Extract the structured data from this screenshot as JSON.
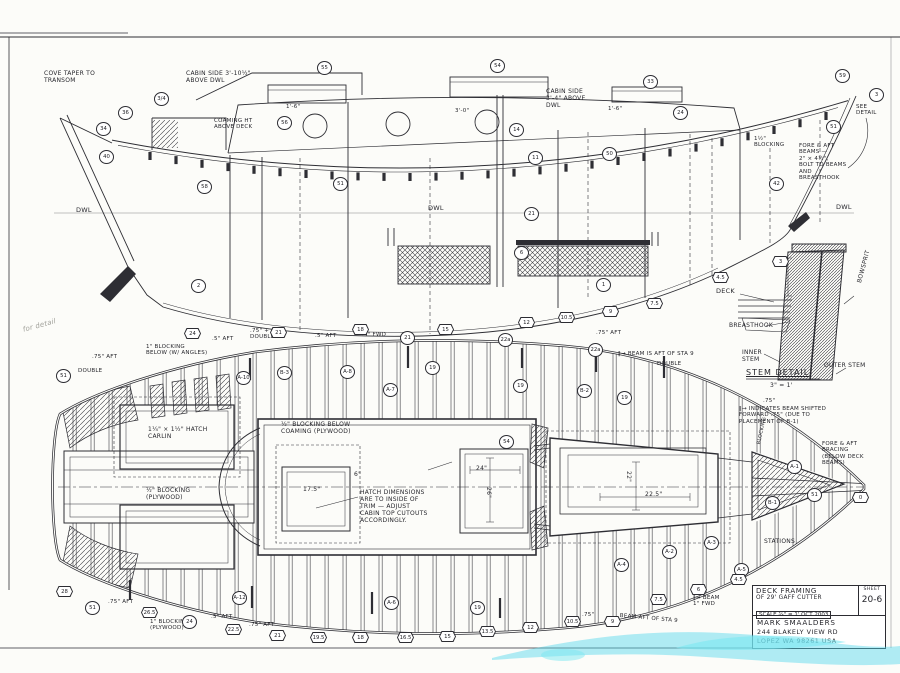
{
  "sheet": {
    "background": "#fcfcf9",
    "ink": "#2e2e34",
    "watermark_color": "#52d8ea"
  },
  "title_block": {
    "title": "DECK FRAMING",
    "subtitle": "OF 29' GAFF CUTTER",
    "scale_line": "SCALE ¾\" = 1'   OCT 2003",
    "designer": "MARK SMAALDERS",
    "address_line1": "244 BLAKELY VIEW RD",
    "address_line2": "LOPEZ WA 98261 USA",
    "sheet_label": "SHEET",
    "sheet_number": "20-6"
  },
  "stem_detail": {
    "title": "STEM DETAIL",
    "scale": "3\" = 1'",
    "labels": [
      {
        "t": "DECK",
        "x": 716,
        "y": 288,
        "s": 6.5
      },
      {
        "t": "BREASTHOOK",
        "x": 729,
        "y": 322,
        "s": 6
      },
      {
        "t": "INNER\nSTEM",
        "x": 742,
        "y": 349,
        "s": 6
      },
      {
        "t": "OUTER STEM",
        "x": 824,
        "y": 362,
        "s": 6
      },
      {
        "t": "BOWSPRIT",
        "x": 856,
        "y": 282,
        "r": -75,
        "s": 6
      }
    ]
  },
  "profile_view": {
    "annotations": [
      {
        "t": "COVE TAPER TO\nTRANSOM",
        "x": 44,
        "y": 70,
        "s": 6
      },
      {
        "t": "CABIN SIDE 3'-10½\"\nABOVE DWL",
        "x": 186,
        "y": 70,
        "s": 6
      },
      {
        "t": "COAMING HT\nABOVE DECK",
        "x": 214,
        "y": 118,
        "s": 5.5
      },
      {
        "t": "1'-6\"",
        "x": 286,
        "y": 104,
        "s": 5.5
      },
      {
        "t": "3'-0\"",
        "x": 455,
        "y": 108,
        "s": 5.5
      },
      {
        "t": "1'-6\"",
        "x": 608,
        "y": 106,
        "s": 5.5
      },
      {
        "t": "CABIN SIDE\n3'-4\" ABOVE\nDWL",
        "x": 546,
        "y": 88,
        "s": 6
      },
      {
        "t": "1½\"\nBLOCKING",
        "x": 754,
        "y": 136,
        "s": 5.5
      },
      {
        "t": "FORE & AFT\nBEAMS —\n2\" × 4½\",\nBOLT TO BEAMS\nAND\nBREASTHOOK",
        "x": 799,
        "y": 143,
        "s": 5.5
      },
      {
        "t": "SEE\nDETAIL",
        "x": 856,
        "y": 104,
        "s": 5.5
      },
      {
        "t": "DWL",
        "x": 76,
        "y": 207,
        "s": 6.5
      },
      {
        "t": "DWL",
        "x": 428,
        "y": 205,
        "s": 6.5
      },
      {
        "t": "DWL",
        "x": 836,
        "y": 204,
        "s": 6.5
      }
    ],
    "markers": [
      {
        "shape": "circle",
        "l": "3/4",
        "x": 154,
        "y": 92
      },
      {
        "shape": "circle",
        "l": "36",
        "x": 118,
        "y": 106
      },
      {
        "shape": "circle",
        "l": "34",
        "x": 96,
        "y": 122
      },
      {
        "shape": "circle",
        "l": "40",
        "x": 99,
        "y": 150
      },
      {
        "shape": "circle",
        "l": "58",
        "x": 197,
        "y": 180
      },
      {
        "shape": "circle",
        "l": "56",
        "x": 277,
        "y": 116
      },
      {
        "shape": "circle",
        "l": "55",
        "x": 317,
        "y": 61
      },
      {
        "shape": "circle",
        "l": "51",
        "x": 333,
        "y": 177
      },
      {
        "shape": "circle",
        "l": "54",
        "x": 490,
        "y": 59
      },
      {
        "shape": "circle",
        "l": "14",
        "x": 509,
        "y": 123
      },
      {
        "shape": "circle",
        "l": "11",
        "x": 528,
        "y": 151
      },
      {
        "shape": "circle",
        "l": "33",
        "x": 643,
        "y": 75
      },
      {
        "shape": "circle",
        "l": "24",
        "x": 673,
        "y": 106
      },
      {
        "shape": "circle",
        "l": "50",
        "x": 602,
        "y": 147
      },
      {
        "shape": "circle",
        "l": "59",
        "x": 835,
        "y": 69
      },
      {
        "shape": "circle",
        "l": "3",
        "x": 869,
        "y": 88
      },
      {
        "shape": "circle",
        "l": "51",
        "x": 826,
        "y": 120
      },
      {
        "shape": "circle",
        "l": "42",
        "x": 769,
        "y": 177
      },
      {
        "shape": "circle",
        "l": "21",
        "x": 524,
        "y": 207
      },
      {
        "shape": "circle",
        "l": "6",
        "x": 514,
        "y": 246
      },
      {
        "shape": "circle",
        "l": "1",
        "x": 596,
        "y": 278
      },
      {
        "shape": "circle",
        "l": "2",
        "x": 191,
        "y": 279
      },
      {
        "shape": "hex",
        "l": "10.5",
        "x": 558,
        "y": 312
      },
      {
        "shape": "hex",
        "l": "9",
        "x": 602,
        "y": 306
      },
      {
        "shape": "hex",
        "l": "7.5",
        "x": 646,
        "y": 298
      },
      {
        "shape": "hex",
        "l": "4.5",
        "x": 712,
        "y": 272
      },
      {
        "shape": "hex",
        "l": "3",
        "x": 772,
        "y": 256
      }
    ]
  },
  "plan_view": {
    "annotations": [
      {
        "t": "for detail",
        "x": 22,
        "y": 326,
        "r": -15,
        "pencil": 1
      },
      {
        "t": ".75\" AFT",
        "x": 92,
        "y": 354,
        "s": 5.5
      },
      {
        "t": "DOUBLE",
        "x": 78,
        "y": 368,
        "s": 5.5
      },
      {
        "t": "1\" BLOCKING\nBELOW (W/ ANGLES)",
        "x": 146,
        "y": 344,
        "s": 5.5
      },
      {
        "t": ".5\" AFT",
        "x": 212,
        "y": 336,
        "s": 5.5
      },
      {
        "t": ".75\" +\nDOUBLE",
        "x": 250,
        "y": 328,
        "s": 5.5
      },
      {
        "t": ".5\" AFT",
        "x": 315,
        "y": 333,
        "s": 5.5
      },
      {
        "t": ".5\" FWD",
        "x": 362,
        "y": 332,
        "s": 5.5
      },
      {
        "t": ".75\" AFT",
        "x": 596,
        "y": 330,
        "s": 5.5
      },
      {
        "t": "‖→ BEAM IS AFT OF STA 9",
        "x": 618,
        "y": 351,
        "s": 5.5
      },
      {
        "t": "DOUBLE",
        "x": 657,
        "y": 361,
        "s": 5.5
      },
      {
        "t": "1¼\" × 1½\" HATCH\nCARLIN",
        "x": 148,
        "y": 426,
        "s": 6
      },
      {
        "t": "½\" BLOCKING\n(PLYWOOD)",
        "x": 146,
        "y": 487,
        "s": 6
      },
      {
        "t": "½\" BLOCKING BELOW\nCOAMING (PLYWOOD)",
        "x": 281,
        "y": 421,
        "s": 6
      },
      {
        "t": "HATCH DIMENSIONS\nARE TO INSIDE OF\nTRIM — ADJUST\nCABIN TOP CUTOUTS\nACCORDINGLY.",
        "x": 360,
        "y": 489,
        "s": 6
      },
      {
        "t": "6\"",
        "x": 354,
        "y": 471,
        "s": 6
      },
      {
        "t": "17.5\"",
        "x": 303,
        "y": 486,
        "s": 6
      },
      {
        "t": "24\"",
        "x": 476,
        "y": 465,
        "s": 6
      },
      {
        "t": "26\"",
        "x": 492,
        "y": 487,
        "s": 6,
        "r": 90
      },
      {
        "t": "22\"",
        "x": 632,
        "y": 471,
        "s": 6,
        "r": 90
      },
      {
        "t": "22.5\"",
        "x": 645,
        "y": 491,
        "s": 6
      },
      {
        "t": ".75\"",
        "x": 763,
        "y": 398,
        "s": 5.5
      },
      {
        "t": "‖→ INDICATES BEAM SHIFTED\nFORWARD .75\" (DUE TO\nPLACEMENT OF B-1)",
        "x": 739,
        "y": 406,
        "s": 5.5
      },
      {
        "t": "FORE & AFT\nBRACING\n(BELOW DECK\nBEAMS)",
        "x": 822,
        "y": 441,
        "s": 5.5
      },
      {
        "t": "BLOCKING",
        "x": 757,
        "y": 444,
        "r": -78,
        "s": 5
      },
      {
        "t": "STATIONS",
        "x": 764,
        "y": 538,
        "s": 6
      },
      {
        "t": "1\" BLOCKING\n(PLYWOOD)",
        "x": 150,
        "y": 619,
        "s": 5.5
      },
      {
        "t": ".75\" AFT",
        "x": 108,
        "y": 599,
        "s": 5.5
      },
      {
        "t": ".5\" AFT",
        "x": 211,
        "y": 614,
        "s": 5.5
      },
      {
        "t": ".75\" AFT",
        "x": 249,
        "y": 622,
        "s": 5.5
      },
      {
        "t": ".75\"",
        "x": 582,
        "y": 612,
        "s": 5.5
      },
      {
        "t": "‖→ BEAM\n1\" FWD",
        "x": 693,
        "y": 595,
        "s": 5.5
      },
      {
        "t": "BEAM AFT OF STA 9",
        "x": 620,
        "y": 613,
        "s": 5.5,
        "r": 5
      }
    ],
    "markers": [
      {
        "shape": "circle",
        "l": "51",
        "x": 56,
        "y": 369
      },
      {
        "shape": "circle",
        "l": "A-10",
        "x": 236,
        "y": 371
      },
      {
        "shape": "circle",
        "l": "B-3",
        "x": 277,
        "y": 366
      },
      {
        "shape": "circle",
        "l": "A-8",
        "x": 340,
        "y": 365
      },
      {
        "shape": "circle",
        "l": "A-7",
        "x": 383,
        "y": 383
      },
      {
        "shape": "circle",
        "l": "19",
        "x": 425,
        "y": 361
      },
      {
        "shape": "circle",
        "l": "21",
        "x": 400,
        "y": 331
      },
      {
        "shape": "circle",
        "l": "22a",
        "x": 498,
        "y": 333
      },
      {
        "shape": "circle",
        "l": "22a",
        "x": 588,
        "y": 343
      },
      {
        "shape": "circle",
        "l": "19",
        "x": 513,
        "y": 379
      },
      {
        "shape": "circle",
        "l": "B-2",
        "x": 577,
        "y": 384
      },
      {
        "shape": "circle",
        "l": "19",
        "x": 617,
        "y": 391
      },
      {
        "shape": "circle",
        "l": "54",
        "x": 499,
        "y": 435
      },
      {
        "shape": "circle",
        "l": "A-6",
        "x": 384,
        "y": 596
      },
      {
        "shape": "circle",
        "l": "19",
        "x": 470,
        "y": 601
      },
      {
        "shape": "circle",
        "l": "A-4",
        "x": 614,
        "y": 558
      },
      {
        "shape": "circle",
        "l": "A-2",
        "x": 662,
        "y": 545
      },
      {
        "shape": "circle",
        "l": "A-3",
        "x": 704,
        "y": 536
      },
      {
        "shape": "circle",
        "l": "A-5",
        "x": 734,
        "y": 563
      },
      {
        "shape": "circle",
        "l": "A-1",
        "x": 787,
        "y": 460
      },
      {
        "shape": "circle",
        "l": "51",
        "x": 807,
        "y": 488
      },
      {
        "shape": "circle",
        "l": "B-1",
        "x": 765,
        "y": 496
      },
      {
        "shape": "circle",
        "l": "51",
        "x": 85,
        "y": 601
      },
      {
        "shape": "circle",
        "l": "24",
        "x": 182,
        "y": 615
      },
      {
        "shape": "circle",
        "l": "A-12",
        "x": 232,
        "y": 591
      },
      {
        "shape": "hex",
        "l": "24",
        "x": 184,
        "y": 328
      },
      {
        "shape": "hex",
        "l": "21",
        "x": 270,
        "y": 327
      },
      {
        "shape": "hex",
        "l": "18",
        "x": 352,
        "y": 324
      },
      {
        "shape": "hex",
        "l": "15",
        "x": 437,
        "y": 324
      },
      {
        "shape": "hex",
        "l": "12",
        "x": 518,
        "y": 317
      },
      {
        "shape": "hex",
        "l": "28",
        "x": 56,
        "y": 586
      },
      {
        "shape": "hex",
        "l": "26.5",
        "x": 141,
        "y": 607
      },
      {
        "shape": "hex",
        "l": "22.5",
        "x": 225,
        "y": 624
      },
      {
        "shape": "hex",
        "l": "21",
        "x": 269,
        "y": 630
      },
      {
        "shape": "hex",
        "l": "19.5",
        "x": 310,
        "y": 632
      },
      {
        "shape": "hex",
        "l": "18",
        "x": 352,
        "y": 632
      },
      {
        "shape": "hex",
        "l": "16.5",
        "x": 397,
        "y": 632
      },
      {
        "shape": "hex",
        "l": "15",
        "x": 439,
        "y": 631
      },
      {
        "shape": "hex",
        "l": "13.5",
        "x": 479,
        "y": 626
      },
      {
        "shape": "hex",
        "l": "12",
        "x": 522,
        "y": 622
      },
      {
        "shape": "hex",
        "l": "10.5",
        "x": 564,
        "y": 616
      },
      {
        "shape": "hex",
        "l": "9",
        "x": 604,
        "y": 616
      },
      {
        "shape": "hex",
        "l": "7.5",
        "x": 650,
        "y": 594
      },
      {
        "shape": "hex",
        "l": "6",
        "x": 690,
        "y": 584
      },
      {
        "shape": "hex",
        "l": "4.5",
        "x": 730,
        "y": 574
      },
      {
        "shape": "hex",
        "l": "0",
        "x": 852,
        "y": 492
      }
    ]
  }
}
